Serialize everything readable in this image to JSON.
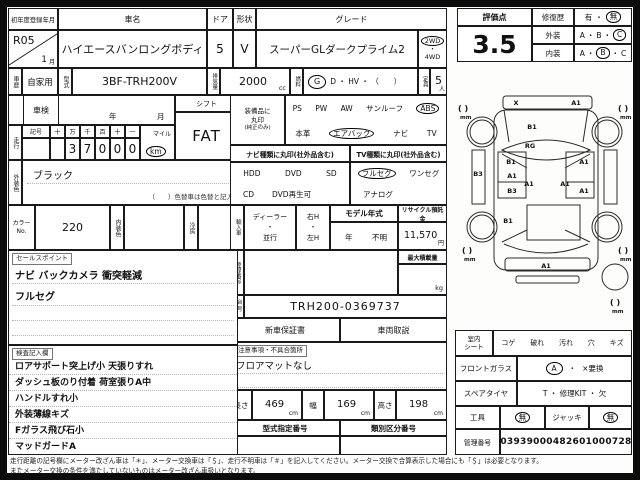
{
  "header": {
    "reg_label": "初年度登録年月",
    "reg_year": "R05",
    "reg_month": "1",
    "month_unit": "月",
    "name_label": "車名",
    "name": "ハイエースバンロングボディ",
    "door_label": "ドア",
    "door": "5",
    "shape_label": "形状",
    "shape": "V",
    "grade_label": "グレード",
    "grade": "スーパーGLダークプライム2",
    "drive_2wd": "2WD",
    "drive_4wd": "4WD",
    "dot": "・",
    "history_label": "車歴",
    "history": "自家用",
    "model_label": "型式",
    "model": "3BF-TRH200V",
    "disp_label": "排気量",
    "disp": "2000",
    "disp_unit": "cc",
    "fuel_label": "燃料",
    "fuel_g": "G",
    "fuel_rest": "D ・ HV ・ （　　）",
    "capacity_label": "定員",
    "capacity": "5",
    "capacity_unit": "人"
  },
  "inspection": {
    "label": "車検",
    "year_unit": "年",
    "month_unit": "月",
    "shift_label": "シフト",
    "shift": "FAT"
  },
  "mileage": {
    "label": "走行",
    "kigo": "記号",
    "h1": "十",
    "h2": "万",
    "h3": "千",
    "h4": "百",
    "h5": "十",
    "h6": "一",
    "d2": "3",
    "d3": "7",
    "d4": "0",
    "d5": "0",
    "d6": "0",
    "mile": "マイル",
    "km": "km"
  },
  "ext_color": {
    "label": "外装色",
    "value": "ブラック",
    "note": "（　　）色替車は色替と記入"
  },
  "equipment": {
    "label1": "装備品に",
    "label2": "丸印",
    "label3": "(純正のみ)",
    "row1": [
      "PS",
      "PW",
      "AW",
      "サンルーフ",
      "ABS"
    ],
    "row2": [
      "本革",
      "エアバック",
      "ナビ",
      "TV"
    ]
  },
  "navi": {
    "header": "ナビ種類に丸印(社外品含む)",
    "row1": [
      "HDD",
      "DVD",
      "SD"
    ],
    "row2": [
      "CD",
      "DVD再生可"
    ]
  },
  "tv": {
    "header": "TV種類に丸印(社外品含む)",
    "row1": [
      "フルセグ",
      "ワンセグ"
    ],
    "row2": [
      "アナログ"
    ]
  },
  "color_no": {
    "label1": "カラー",
    "label2": "No.",
    "value": "220",
    "int_label": "内装色",
    "ac_label": "冷房"
  },
  "import": {
    "label": "輸入車",
    "dealer": "ディーラー",
    "dot": "・",
    "parallel": "並行",
    "rh": "右H",
    "lh": "左H",
    "my_label": "モデル年式",
    "my_year": "年",
    "my_value": "不明",
    "recycle_label": "リサイクル預託金",
    "recycle": "11,570",
    "yen": "円"
  },
  "registration": {
    "label": "登録番号",
    "max_load_label": "最大積載量",
    "kg": "kg"
  },
  "chassis": {
    "label1": "車台",
    "label2": "番号",
    "value": "TRH200-0369737"
  },
  "docs": {
    "warranty": "新車保証書",
    "manual": "車両取説"
  },
  "notes": {
    "tag": "注意事項・不具合箇所",
    "line1": "フロアマットなし"
  },
  "sales": {
    "tag": "セールスポイント",
    "line1": "ナビ バックカメラ 衝突軽減",
    "line2": "フルセグ"
  },
  "inspector": {
    "tag": "検査記入欄",
    "lines": [
      "ロアサポート突上げ小 天張りすれ",
      "ダッシュ板のり付着 荷室張りA中",
      "ハンドルすれ小",
      "外装薄線キズ",
      "Fガラス飛び石小",
      "マッドガードA"
    ]
  },
  "dimensions": {
    "len_label": "長さ",
    "len": "469",
    "wid_label": "幅",
    "wid": "169",
    "hei_label": "高さ",
    "hei": "198",
    "cm": "cm",
    "type_no_label": "型式指定番号",
    "class_no_label": "類別区分番号"
  },
  "score": {
    "label": "評価点",
    "value": "3.5",
    "repair_label": "修復歴",
    "yes": "有",
    "no": "無",
    "dot": "・",
    "ext_label": "外装",
    "int_label": "内装",
    "a": "A",
    "b": "B",
    "c": "C"
  },
  "right_table": {
    "seat_label1": "室内",
    "seat_label2": "シート",
    "seat_items": [
      "コゲ",
      "破れ",
      "汚れ",
      "穴",
      "キズ"
    ],
    "glass_label": "フロントガラス",
    "glass_a": "A",
    "dot": "・",
    "glass_x": "×要換",
    "spare_label": "スペアタイヤ",
    "spare_value": "T ・ 修理KIT ・ 欠",
    "tool_label": "工具",
    "tool_value": "無",
    "jack_label": "ジャッキ",
    "jack_value": "無",
    "mgmt_label": "管理番号",
    "mgmt_value": "03939000482601000728"
  },
  "diagram": {
    "bracket": "(  )",
    "mm": "mm",
    "marks": {
      "front_bumper_left": "X",
      "front_bumper_right": "A1",
      "hood": "B1",
      "windshield": "RG",
      "left_sill": "B3",
      "left_front_door": "B1",
      "left_door_mid": "A1",
      "left_slide_door": "B3",
      "center": "A1",
      "right_front_door": "A1",
      "right_door_mid": "A1",
      "right_slide_door": "A1",
      "left_quarter": "B1",
      "rear_bumper": "A1"
    }
  },
  "footer": {
    "line1": "走行距離の記号欄にメーター改ざん車は「＊」、メーター交換車は「＄」、走行不明車は「＃」を記入してください。メーター交換で合算表示した場合にも「＄」は必要となります。",
    "line2": "またメーター交換の条件を満たしていないものはメーター改ざん車扱いとなります。"
  }
}
